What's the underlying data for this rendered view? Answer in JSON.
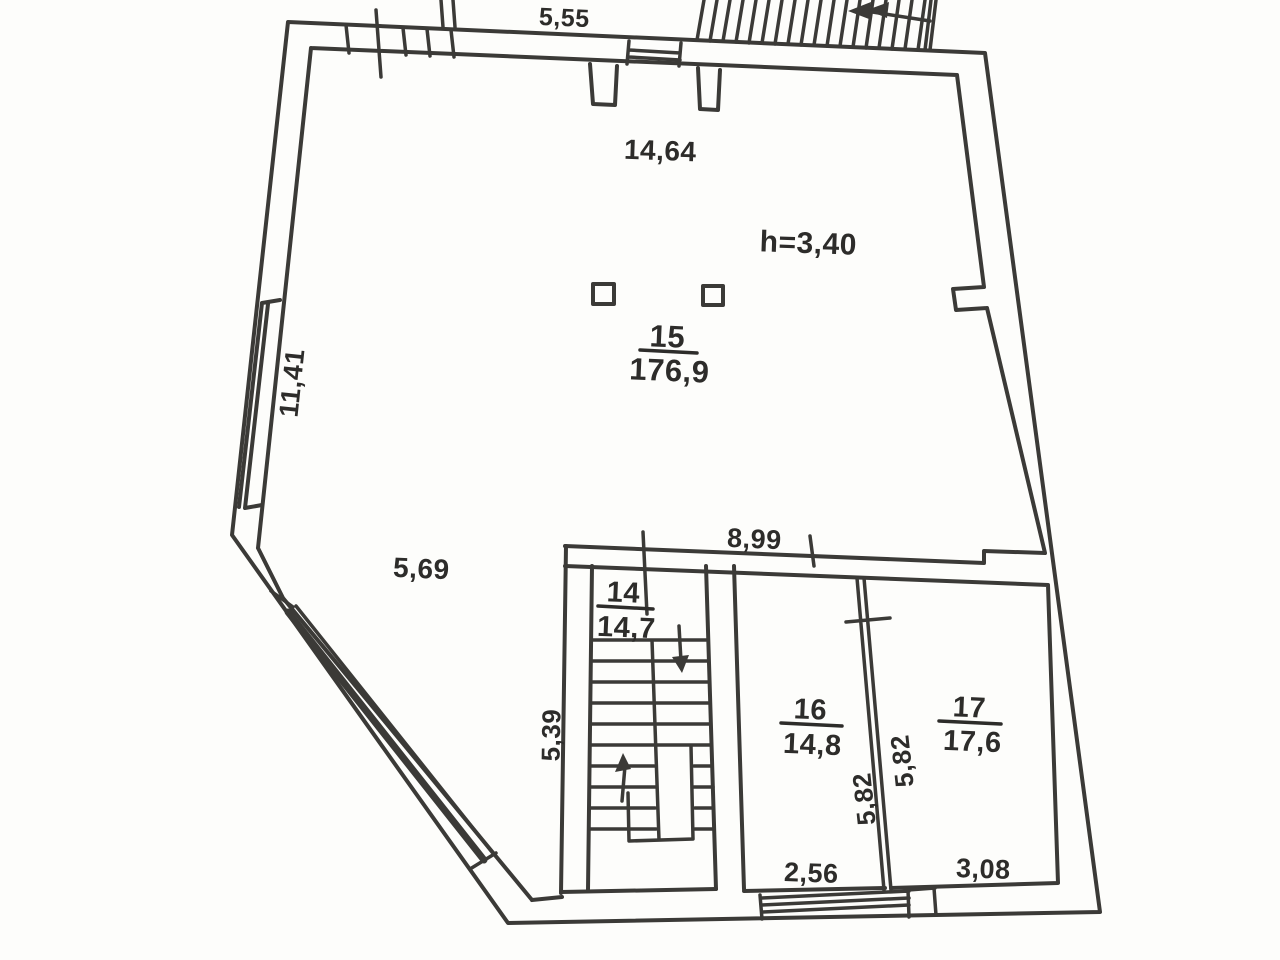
{
  "plan": {
    "rooms": {
      "r15": {
        "number": "15",
        "area": "176,9"
      },
      "r14": {
        "number": "14",
        "area": "14,7"
      },
      "r16": {
        "number": "16",
        "area": "14,8"
      },
      "r17": {
        "number": "17",
        "area": "17,6"
      }
    },
    "annotations": {
      "ceiling_height": "h=3,40"
    },
    "dimensions": {
      "top_exterior": "5,55",
      "hall_width": "14,64",
      "left_wall": "11,41",
      "diagonal_wall": "5,69",
      "hall_band": "8,99",
      "stairwell_depth": "5,39",
      "partition_left": "5,82",
      "partition_right": "5,82",
      "room16_width": "2,56",
      "room17_width": "3,08"
    },
    "colors": {
      "ink": "#3b3a37",
      "text": "#2d2c2a",
      "paper": "#fdfdfb"
    }
  }
}
